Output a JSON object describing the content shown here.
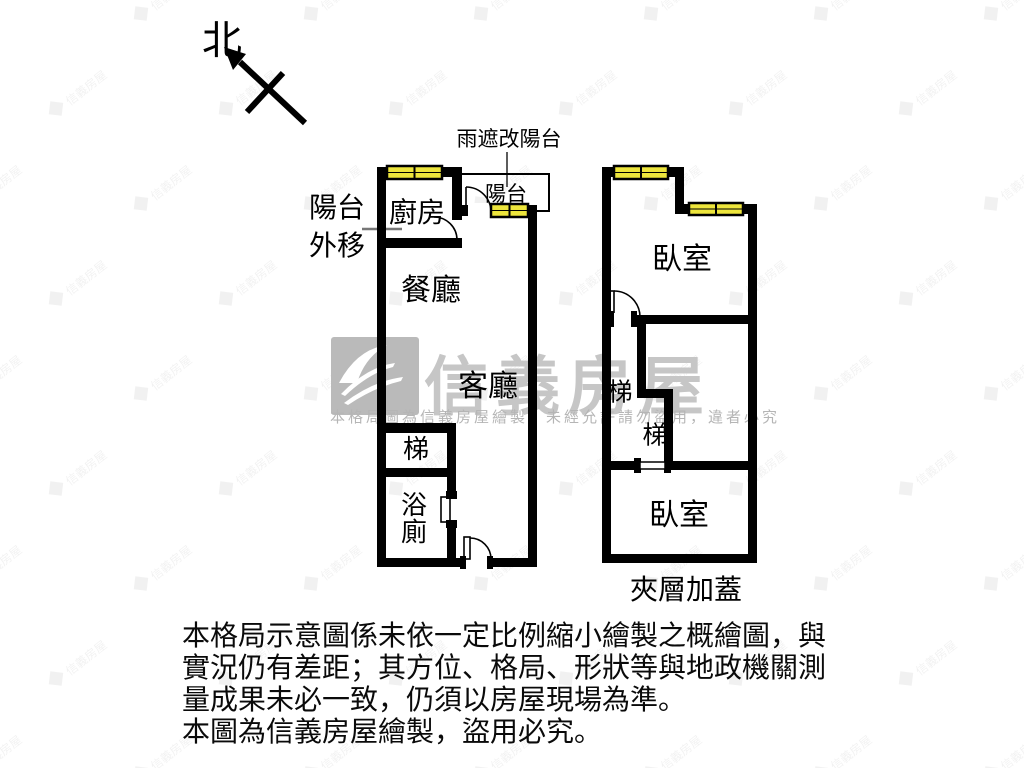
{
  "compass": {
    "label": "北"
  },
  "colors": {
    "wall": "#000000",
    "window_fill": "#ede53c",
    "watermark_text": "#c6c6c6",
    "logo_gray": "#bababa"
  },
  "plan_left": {
    "rain_note": "雨遮改陽台",
    "balcony_moved": "陽台\n外移",
    "kitchen": "廚房",
    "balcony": "陽台",
    "dining": "餐廳",
    "living": "客廳",
    "stairs": "梯",
    "bathroom": "浴廁"
  },
  "plan_right": {
    "bedroom_upper": "臥室",
    "stairs_upper": "梯",
    "stairs_lower": "梯",
    "bedroom_lower": "臥室",
    "caption": "夾層加蓋"
  },
  "watermark": {
    "brand": "信義房屋",
    "notice": "本格局圖為信義房屋繪製，未經允許請勿盜用，違者必究"
  },
  "disclaimer": {
    "lines": [
      "本格局示意圖係未依一定比例縮小繪製之概繪圖，與",
      "實況仍有差距；其方位、格局、形狀等與地政機關測",
      "量成果未必一致，仍須以房屋現場為準。",
      "本圖為信義房屋繪製，盜用必究。"
    ]
  }
}
